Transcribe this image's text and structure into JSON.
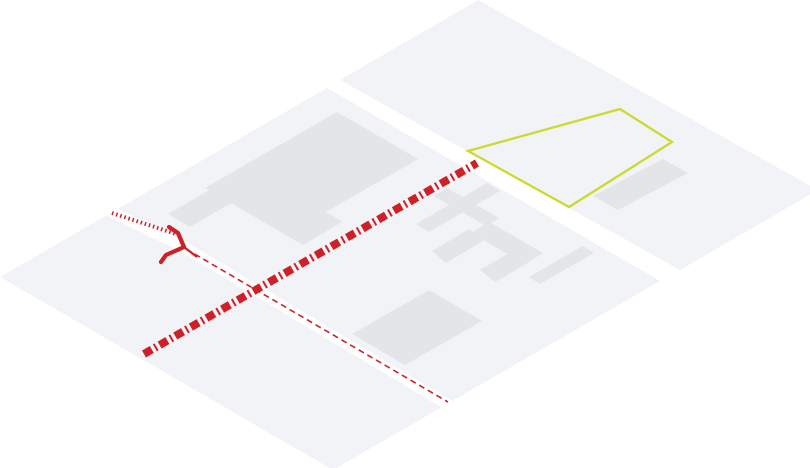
{
  "scene": {
    "width": 810,
    "height": 468,
    "description": "Isometric map illustration of two city blocks separated by streets, with building footprints, a highlighted lot outline, a bold dashed route, a thin dashed property line, a dotted lead-in line and a fork junction marker"
  },
  "colors": {
    "background": "#ffffff",
    "block_fill": "#f2f3f7",
    "building_fill": "#e3e5e9",
    "street_fill": "#ffffff",
    "route_red": "#ce2127",
    "highlight_yellow": "#ccd92f"
  },
  "layers": [
    {
      "name": "left-city-block",
      "kind": "polygon",
      "points": "327,88 660,281 333,470 0,277",
      "fill": "block_fill"
    },
    {
      "name": "right-city-block",
      "kind": "polygon",
      "points": "478,0 818,190 680,270 340,80",
      "fill": "block_fill"
    },
    {
      "name": "inner-street",
      "kind": "polyline",
      "points": "108,210 184,247 455,409",
      "stroke": "street_fill",
      "width": 11,
      "linejoin": "round"
    },
    {
      "name": "building-large-L",
      "kind": "polygon",
      "points": "337,112 418,159 326,212 342,222 303,245 205,188",
      "fill": "building_fill"
    },
    {
      "name": "building-small-west",
      "kind": "polygon",
      "points": "168,214 230,178 252,191 190,227",
      "fill": "building_fill"
    },
    {
      "name": "building-bar-1",
      "kind": "polygon",
      "points": "416,224 487,183 500,191 429,232",
      "fill": "building_fill"
    },
    {
      "name": "building-bar-2",
      "kind": "polygon",
      "points": "447,188 499,218 486,226 434,196",
      "fill": "building_fill"
    },
    {
      "name": "building-bar-3",
      "kind": "polygon",
      "points": "489,222 543,253 525,264 471,233",
      "fill": "building_fill"
    },
    {
      "name": "building-bar-4",
      "kind": "polygon",
      "points": "432,251 469,229 483,241 446,263",
      "fill": "building_fill"
    },
    {
      "name": "building-bar-5",
      "kind": "polygon",
      "points": "480,270 516,249 531,261 495,282",
      "fill": "building_fill"
    },
    {
      "name": "building-bar-6",
      "kind": "polygon",
      "points": "529,277 583,246 594,253 540,284",
      "fill": "building_fill"
    },
    {
      "name": "building-medium-south",
      "kind": "polygon",
      "points": "352,334 429,290 482,321 405,365",
      "fill": "building_fill"
    },
    {
      "name": "building-east-bar",
      "kind": "polygon",
      "points": "593,196 663,159 688,173 618,210",
      "fill": "building_fill"
    },
    {
      "name": "highlighted-lot-outline",
      "kind": "polygon",
      "points": "468,151 620,109 672,142 569,207",
      "fill": "none",
      "stroke": "highlight_yellow",
      "width": 2.3,
      "linejoin": "miter"
    },
    {
      "name": "thin-dashed-property-line",
      "kind": "line",
      "x1": 186,
      "y1": 249,
      "x2": 448,
      "y2": 402,
      "stroke": "route_red",
      "width": 1.6,
      "dash": "6 4"
    },
    {
      "name": "dotted-lead-line",
      "kind": "line",
      "x1": 112,
      "y1": 213,
      "x2": 176,
      "y2": 234,
      "stroke": "route_red",
      "width": 4,
      "dash": "1.5 2.8"
    },
    {
      "name": "fork-marker-upper-arm",
      "kind": "polyline",
      "points": "169,227 178,233 184,247",
      "stroke": "route_red",
      "width": 4.2,
      "linejoin": "round",
      "cap": "round"
    },
    {
      "name": "fork-marker-lower-arm",
      "kind": "polyline",
      "points": "184,247 166,255 161,262",
      "stroke": "route_red",
      "width": 4.2,
      "linejoin": "round",
      "cap": "round"
    },
    {
      "name": "fork-marker-stem",
      "kind": "line",
      "x1": 184,
      "y1": 247,
      "x2": 197,
      "y2": 257,
      "stroke": "route_red",
      "width": 2.2
    },
    {
      "name": "route-dashed-thick",
      "kind": "line",
      "x1": 144,
      "y1": 354,
      "x2": 477,
      "y2": 163,
      "stroke": "route_red",
      "width": 8,
      "dash": "9 3.5 2 3.5"
    }
  ]
}
